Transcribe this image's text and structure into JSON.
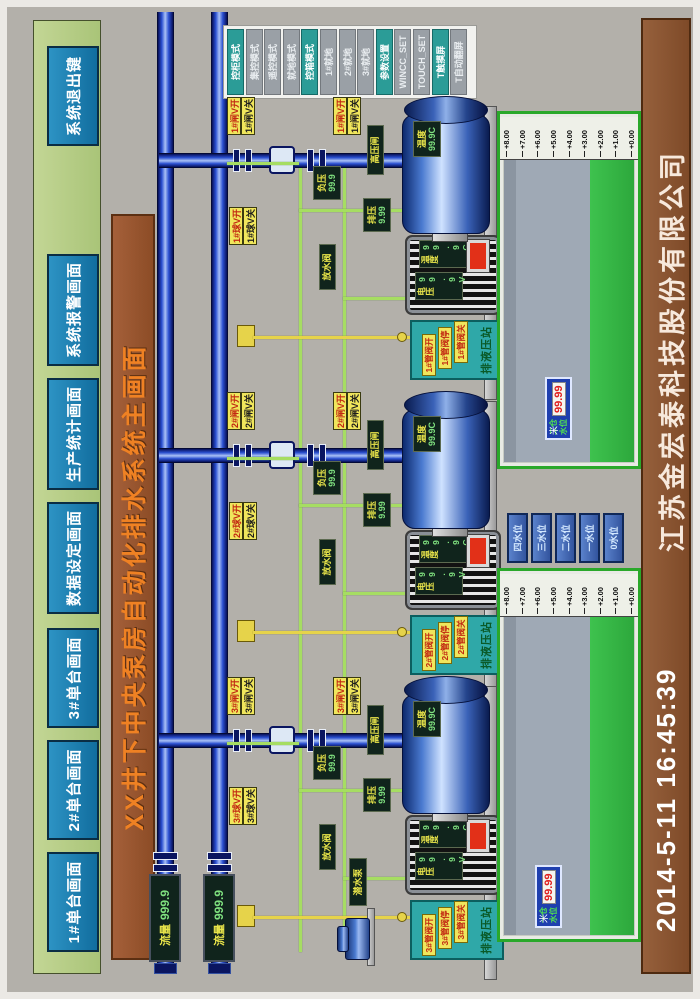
{
  "nav": {
    "buttons": [
      "1#单台画面",
      "2#单台画面",
      "3#单台画面",
      "数据设定画面",
      "生产统计画面",
      "系统报警画面",
      "系统退出键"
    ]
  },
  "title": "XX井下中央泵房自动化排水系统主画面",
  "mode_buttons": [
    {
      "label": "控柜模式",
      "active": true
    },
    {
      "label": "集控模式",
      "active": false
    },
    {
      "label": "遥控模式",
      "active": false
    },
    {
      "label": "就地模式",
      "active": false
    },
    {
      "label": "控箱模式",
      "active": true
    },
    {
      "label": "1#就地",
      "active": false
    },
    {
      "label": "2#就地",
      "active": false
    },
    {
      "label": "3#就地",
      "active": false
    },
    {
      "label": "参数设置",
      "active": true
    },
    {
      "label": "WINCC_SET",
      "active": false
    },
    {
      "label": "TOUCH_SET",
      "active": false
    },
    {
      "label": "T触摸屏",
      "active": true
    },
    {
      "label": "T自动翻屏",
      "active": false
    }
  ],
  "flow_meters": [
    {
      "label": "流量",
      "value": "999.9"
    },
    {
      "label": "流量",
      "value": "999.9"
    }
  ],
  "units": [
    {
      "id": "1#",
      "valves": {
        "gate_open": "1#闸V开",
        "gate_close": "1#闸V关",
        "ball_open": "1#球V开",
        "ball_close": "1#球V关",
        "gate2_open": "1#闸V开",
        "gate2_close": "1#闸V关"
      },
      "labels": {
        "discharge": "高压闸",
        "vacuum_label": "负压",
        "vacuum_value": "99.9",
        "pressure_label": "排压",
        "pressure_value": "9.99",
        "drain": "放水阀"
      },
      "hydraulic": {
        "title": "排液压站",
        "buttons": [
          "1#管阀开",
          "1#管阀停",
          "1#管阀关"
        ]
      },
      "pump": {
        "temp_label": "温度",
        "temp_value": "99.9C"
      },
      "motor": {
        "volt_label": "电压",
        "volt_value": "99.9V",
        "temp_label": "温度",
        "temp_value": "99.9C"
      }
    },
    {
      "id": "2#",
      "valves": {
        "gate_open": "2#闸V开",
        "gate_close": "2#闸V关",
        "ball_open": "2#球V开",
        "ball_close": "2#球V关",
        "gate2_open": "2#闸V开",
        "gate2_close": "2#闸V关"
      },
      "labels": {
        "discharge": "高压闸",
        "vacuum_label": "负压",
        "vacuum_value": "99.9",
        "pressure_label": "排压",
        "pressure_value": "9.99",
        "drain": "放水阀"
      },
      "hydraulic": {
        "title": "排液压站",
        "buttons": [
          "2#管阀开",
          "2#管阀停",
          "2#管阀关"
        ]
      },
      "pump": {
        "temp_label": "温度",
        "temp_value": "99.9C"
      },
      "motor": {
        "volt_label": "电压",
        "volt_value": "99.9V",
        "temp_label": "温度",
        "temp_value": "99.9C"
      }
    },
    {
      "id": "3#",
      "valves": {
        "gate_open": "3#闸V开",
        "gate_close": "3#闸V关",
        "ball_open": "3#球V开",
        "ball_close": "3#球V关",
        "gate2_open": "3#闸V开",
        "gate2_close": "3#闸V关"
      },
      "labels": {
        "discharge": "高压闸",
        "vacuum_label": "负压",
        "vacuum_value": "99.9",
        "pressure_label": "排压",
        "pressure_value": "9.99",
        "drain": "放水阀"
      },
      "hydraulic": {
        "title": "排液压站",
        "buttons": [
          "3#管阀开",
          "3#管阀停",
          "3#管阀关"
        ]
      },
      "pump": {
        "temp_label": "温度",
        "temp_value": "99.9C"
      },
      "motor": {
        "volt_label": "电压",
        "volt_value": "99.9V",
        "temp_label": "温度",
        "temp_value": "99.9C"
      }
    }
  ],
  "sumps": {
    "scale": [
      "+8.00",
      "+7.00",
      "+6.00",
      "+5.00",
      "+4.00",
      "+3.00",
      "+2.00",
      "+1.00",
      "+0.00"
    ],
    "level_marks": [
      "四水位",
      "三水位",
      "二水位",
      "一水位",
      "0水位"
    ],
    "left_box": {
      "name1": "一仓",
      "name2": "水位",
      "value": "99.99",
      "unit": "米"
    },
    "right_box": {
      "name1": "二仓",
      "name2": "水位",
      "value": "99.99",
      "unit": "米"
    }
  },
  "submersible_label": "潜水泵",
  "footer": {
    "datetime": "2014-5-11  16:45:39",
    "company": "江苏金宏泰科技股份有限公司"
  }
}
